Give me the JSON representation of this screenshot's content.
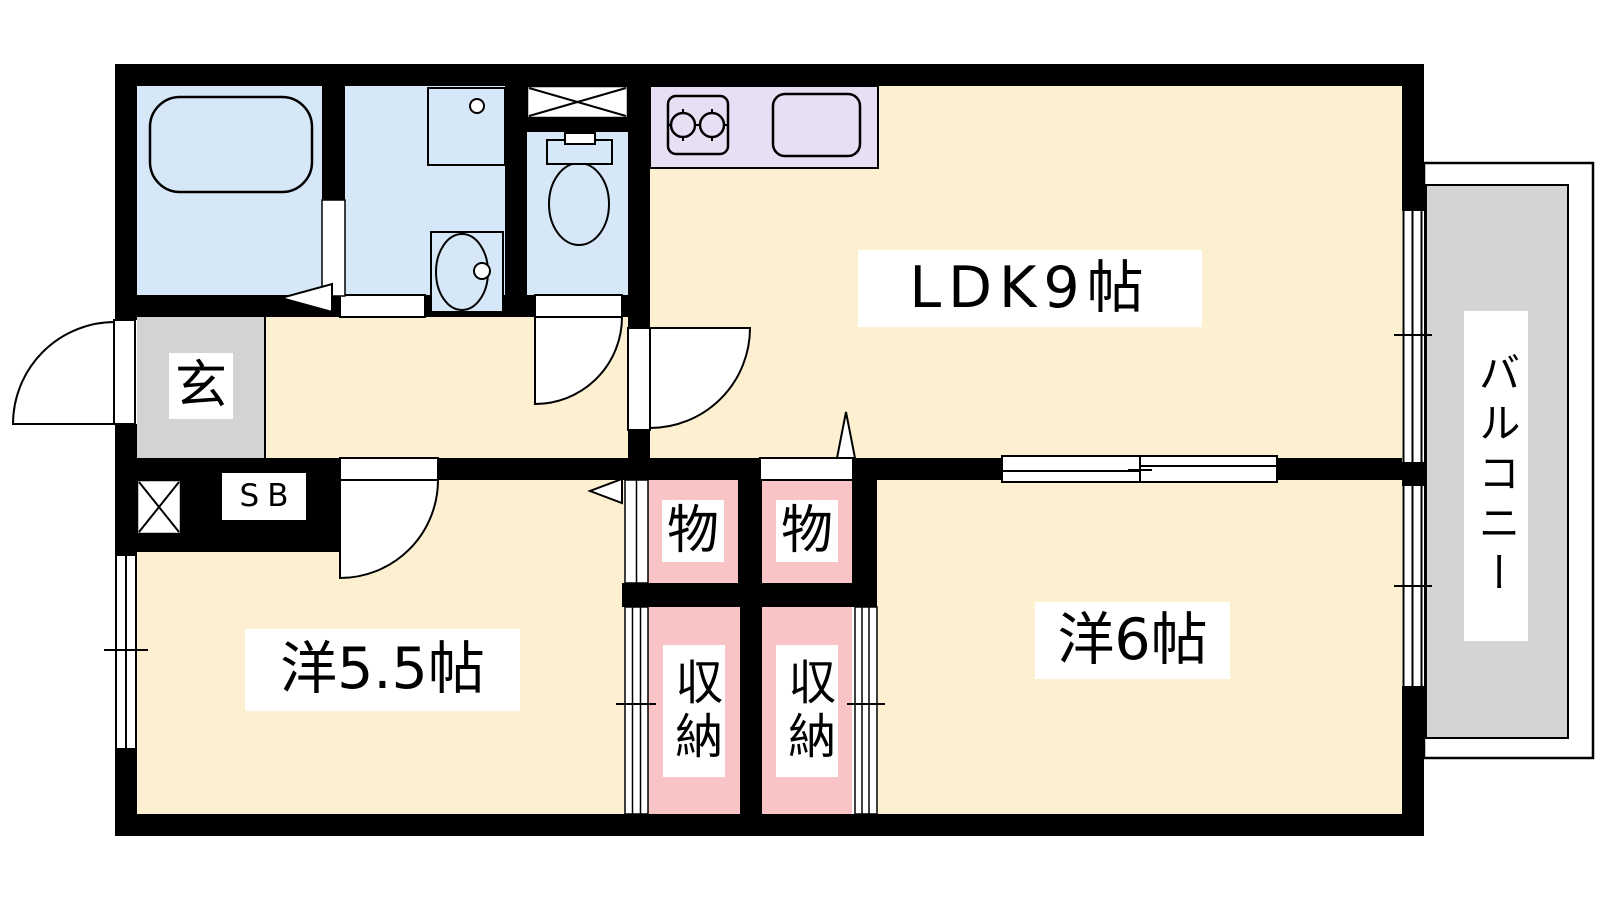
{
  "plan": {
    "type": "apartment-floor-plan",
    "labels": {
      "ldk": "LDK9帖",
      "bedroom_small": "洋5.5帖",
      "bedroom_large": "洋6帖",
      "entrance": "玄",
      "shoe_box": "SB",
      "storage_1": "物",
      "storage_2": "物",
      "closet_1": "収納",
      "closet_2": "収納",
      "balcony": "バルコニー"
    },
    "fixtures": {
      "bathroom": "bathtub",
      "washroom": "washbasin-counter and vanity-basin",
      "toilet_room": "toilet",
      "laundry": "washing-machine-pan-cross-box",
      "kitchen": "two-burner-stove and kitchen-sink",
      "entrance_corner": "cross-box"
    },
    "colors": {
      "wall": "#000000",
      "room_cream": "#FCF0D1",
      "wet_area_blue": "#D6E8F8",
      "kitchen_lavender": "#E7DFF3",
      "closet_pink": "#F9C4C6",
      "entrance_gray": "#D3D3D3",
      "balcony_gray": "#D4D4D4",
      "label_bg": "#FFFFFF"
    }
  }
}
